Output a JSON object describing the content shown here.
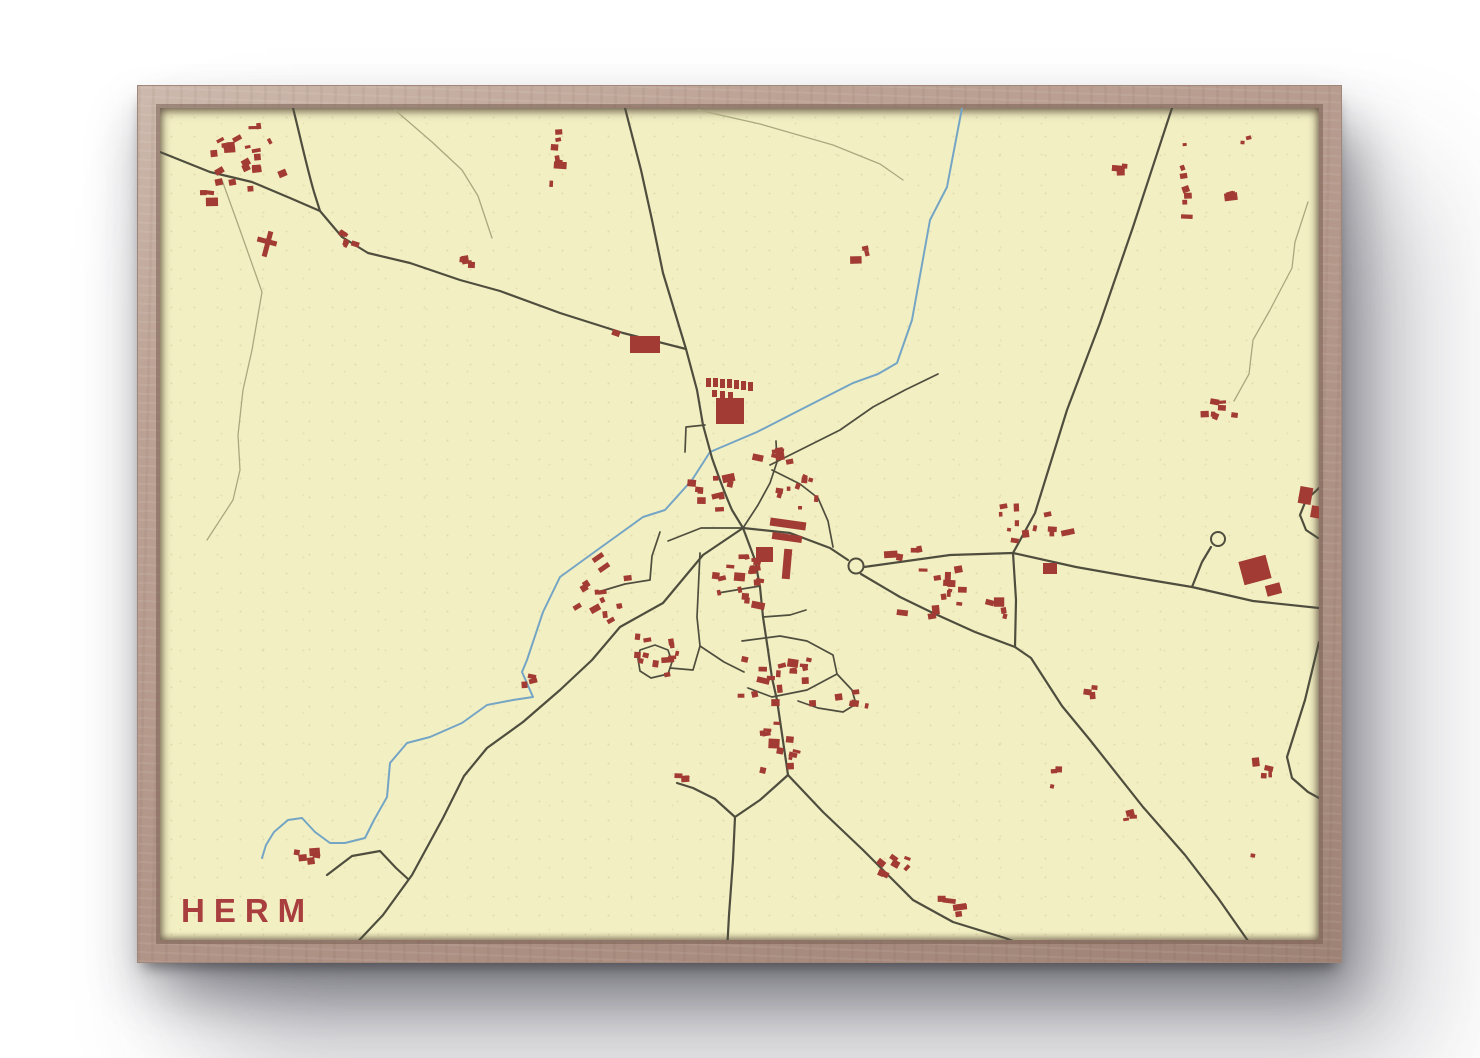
{
  "poster": {
    "title": "HERM"
  },
  "palette": {
    "background": "#ffffff",
    "paper": "#f2efc3",
    "frame_wood": "#b29689",
    "road_main": "#4f4e3e",
    "road_minor": "#aaa87e",
    "river": "#75a5c4",
    "building": "#a23b33",
    "title_color": "#a93e3e"
  },
  "map": {
    "viewbox": "160 108 1159 832",
    "roads_main": [
      "M 160,152 L 210,172 L 252,182 L 290,198 L 320,211 L 342,237 L 368,253 L 410,263 L 460,280 L 500,291 L 560,313 L 623,333 L 686,349",
      "M 293,108 C 301,140 307,168 314,192 L 320,211",
      "M 625,108 L 641,170 L 652,220 L 663,273 L 686,349 L 697,390 L 703,425 L 712,458 C 718,475 724,492 732,510 L 743,528",
      "M 743,528 L 703,555 L 663,603 L 620,627 L 592,660 L 560,690 L 523,722 L 487,748 L 464,776 L 443,818 L 412,875 L 383,915 L 350,950",
      "M 1172,108 L 1133,227 L 1100,323 L 1067,410 L 1035,513 L 1013,553",
      "M 743,528 L 790,533 L 830,548 L 848,560",
      "M 864,567 L 950,555 L 1013,553 L 1076,567 L 1150,580 L 1192,587 L 1253,601 L 1319,608",
      "M 861,574 L 900,597 L 933,613 L 975,632 L 1015,647 L 1031,658 L 1062,706 L 1090,740 L 1143,807 L 1185,855 L 1218,898 L 1253,948",
      "M 1013,553 L 1016,600 L 1015,647",
      "M 743,528 L 755,560 L 760,587 L 763,617 L 768,650 L 772,678 L 777,700 L 788,775",
      "M 788,775 L 823,812 L 863,850 L 913,900 L 953,922 L 1005,938 L 1040,951",
      "M 788,775 L 760,800 L 735,817 L 733,860 L 729,915 L 727,952",
      "M 735,817 L 715,799 L 693,788 L 677,783",
      "M 1319,642 L 1305,700 L 1287,757 L 1292,778 L 1308,792 L 1319,798",
      "M 1192,587 L 1202,562 L 1211,547",
      "M 1319,488 L 1306,500 L 1300,515 L 1306,530 L 1318,538",
      "M 327,875 L 352,856 L 380,851 L 396,868 L 408,879"
    ],
    "streets": [
      "M 640,650 L 655,645 L 668,650 L 672,662 L 668,674 L 651,678 L 640,671 L 638,659 Z",
      "M 670,668 L 693,670 L 700,646",
      "M 700,553 L 697,617 L 700,646 L 724,662 L 744,672",
      "M 660,532 L 652,556 L 650,580 L 625,584 L 598,592",
      "M 743,528 L 701,528 L 668,541",
      "M 743,528 L 758,505 L 770,483 L 777,462 L 776,441",
      "M 772,470 L 800,484 L 818,498 L 828,521 L 833,547",
      "M 770,465 L 806,447 L 840,430 L 873,407 L 905,390 L 938,374",
      "M 705,425 L 686,427 L 685,452",
      "M 760,586 L 718,593",
      "M 763,617 L 790,615 L 806,610",
      "M 742,641 L 780,636 L 807,641 L 833,655 L 837,674 L 807,690 L 772,697 L 748,688",
      "M 837,674 L 852,690 L 856,704 L 843,712 L 818,708 L 798,701"
    ],
    "roads_minor": [
      "M 222,180 L 240,230 L 262,292 L 252,350 L 243,390 L 238,435 L 240,470 L 233,500 L 207,540",
      "M 395,110 L 432,142 L 462,170 L 478,196 L 492,238",
      "M 698,110 L 760,124 L 833,145 L 880,164 L 903,180",
      "M 1308,202 L 1295,242 L 1292,268 L 1270,310 L 1253,340 L 1249,374 L 1234,401",
      "M 1008,939 L 1062,941 L 1117,944 L 1168,951"
    ],
    "river": "M 962,108 L 947,187 L 930,220 L 912,320 L 897,363 L 878,374 L 853,383 L 800,410 L 757,432 L 710,452 L 692,480 L 665,510 L 643,517 L 600,548 L 560,577 L 543,612 L 527,660 L 522,672 L 533,697 L 513,700 L 487,705 L 462,723 L 430,737 L 407,743 L 390,763 L 387,797 L 374,820 L 365,838 L 345,843 L 330,843 L 315,832 L 302,818 L 288,820 L 274,832 L 266,845 L 262,858",
    "roundabouts": [
      {
        "cx": 856,
        "cy": 566,
        "r": 7.5
      },
      {
        "cx": 1218,
        "cy": 539,
        "r": 7
      }
    ],
    "buildings_fixed": [
      [
        630,
        336,
        30,
        17,
        0
      ],
      [
        612,
        330,
        8,
        6,
        20
      ],
      [
        716,
        398,
        28,
        26,
        0
      ],
      [
        706,
        378,
        5,
        9,
        0
      ],
      [
        713,
        378,
        5,
        9,
        0
      ],
      [
        720,
        379,
        5,
        9,
        0
      ],
      [
        727,
        379,
        5,
        9,
        0
      ],
      [
        734,
        380,
        5,
        9,
        0
      ],
      [
        741,
        381,
        5,
        9,
        0
      ],
      [
        748,
        382,
        5,
        9,
        0
      ],
      [
        712,
        390,
        5,
        7,
        0
      ],
      [
        720,
        391,
        5,
        7,
        0
      ],
      [
        728,
        392,
        5,
        7,
        0
      ],
      [
        770,
        520,
        36,
        8,
        8
      ],
      [
        772,
        534,
        30,
        7,
        8
      ],
      [
        783,
        549,
        8,
        30,
        5
      ],
      [
        756,
        547,
        17,
        15,
        0
      ],
      [
        1241,
        558,
        28,
        24,
        -15
      ],
      [
        1266,
        584,
        15,
        11,
        -15
      ],
      [
        1299,
        487,
        13,
        17,
        10
      ],
      [
        1311,
        506,
        10,
        12,
        10
      ],
      [
        265,
        231,
        5,
        26,
        15
      ],
      [
        257,
        239,
        20,
        5,
        15
      ],
      [
        592,
        555,
        12,
        5,
        -35
      ],
      [
        598,
        565,
        12,
        5,
        -35
      ],
      [
        1043,
        563,
        14,
        11,
        0
      ]
    ],
    "building_clusters": [
      [
        243,
        158,
        48,
        38,
        22,
        -15
      ],
      [
        205,
        196,
        10,
        16,
        3,
        0
      ],
      [
        348,
        240,
        18,
        10,
        5,
        20
      ],
      [
        470,
        262,
        12,
        20,
        4,
        0
      ],
      [
        558,
        155,
        13,
        40,
        7,
        0
      ],
      [
        868,
        256,
        16,
        10,
        3,
        0
      ],
      [
        1186,
        185,
        7,
        55,
        7,
        -10
      ],
      [
        1231,
        186,
        6,
        20,
        3,
        -10
      ],
      [
        1122,
        170,
        6,
        18,
        3,
        0
      ],
      [
        1247,
        137,
        5,
        10,
        2,
        0
      ],
      [
        1218,
        408,
        20,
        18,
        7,
        10
      ],
      [
        772,
        452,
        22,
        16,
        7,
        0
      ],
      [
        712,
        490,
        25,
        28,
        10,
        0
      ],
      [
        800,
        495,
        28,
        22,
        9,
        10
      ],
      [
        745,
        580,
        38,
        35,
        20,
        0
      ],
      [
        612,
        595,
        38,
        28,
        12,
        -20
      ],
      [
        655,
        655,
        35,
        28,
        12,
        0
      ],
      [
        780,
        675,
        45,
        35,
        18,
        0
      ],
      [
        780,
        755,
        35,
        25,
        8,
        0
      ],
      [
        940,
        590,
        55,
        35,
        14,
        0
      ],
      [
        1030,
        525,
        60,
        25,
        13,
        0
      ],
      [
        905,
        552,
        22,
        8,
        4,
        0
      ],
      [
        535,
        677,
        14,
        14,
        3,
        0
      ],
      [
        890,
        870,
        35,
        28,
        7,
        30
      ],
      [
        960,
        915,
        28,
        18,
        5,
        0
      ],
      [
        1055,
        770,
        12,
        18,
        3,
        0
      ],
      [
        1090,
        690,
        14,
        10,
        3,
        0
      ],
      [
        1131,
        816,
        12,
        12,
        3,
        0
      ],
      [
        1266,
        775,
        18,
        20,
        4,
        0
      ],
      [
        308,
        856,
        22,
        8,
        5,
        0
      ],
      [
        997,
        610,
        16,
        12,
        4,
        0
      ],
      [
        680,
        778,
        10,
        8,
        3,
        0
      ],
      [
        850,
        700,
        25,
        12,
        5,
        0
      ],
      [
        770,
        730,
        18,
        14,
        4,
        0
      ],
      [
        1253,
        852,
        4,
        4,
        1,
        0
      ]
    ]
  }
}
